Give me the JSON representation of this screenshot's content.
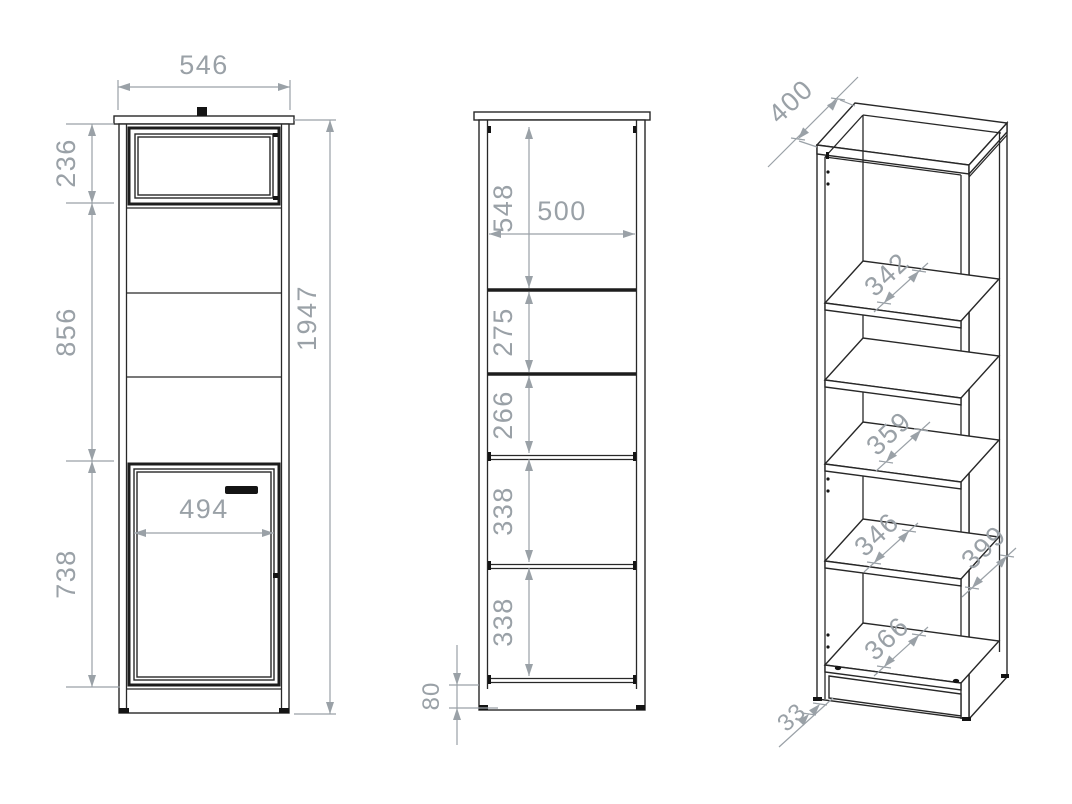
{
  "drawing": {
    "front": {
      "overall_width": "546",
      "overall_height": "1947",
      "top_flap_height": "236",
      "middle_section_height": "856",
      "bottom_door_height": "738",
      "door_inner_width": "494"
    },
    "section": {
      "top_compartment_height": "548",
      "inner_width": "500",
      "compartment_2_height": "275",
      "compartment_3_height": "266",
      "compartment_4_height": "338",
      "compartment_5_height": "338",
      "plinth_height": "80"
    },
    "iso": {
      "top_depth": "400",
      "shelf_1_depth": "342",
      "shelf_2_depth": "359",
      "shelf_3_depth": "346",
      "bottom_depth": "366",
      "side_panel_depth": "399",
      "plinth_recess": "33"
    }
  },
  "colors": {
    "background": "#ffffff",
    "drawing_line": "#282828",
    "dimension": "#9aa1a7",
    "hardware": "#141414"
  }
}
